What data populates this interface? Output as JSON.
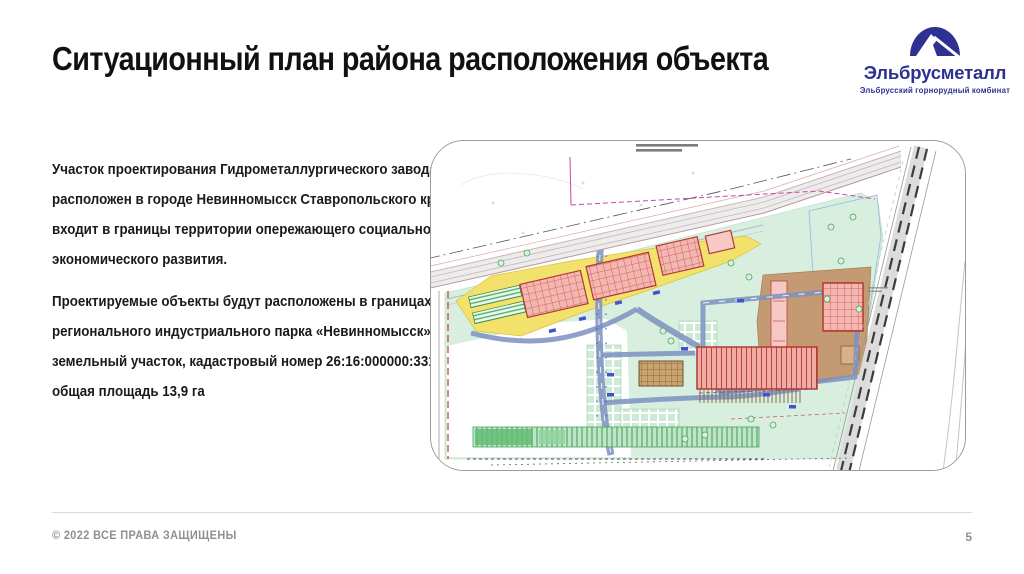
{
  "header": {
    "title": "Ситуационный план района расположения объекта"
  },
  "logo": {
    "name": "Эльбрусметалл",
    "tagline": "Эльбрусский горнорудный комбинат"
  },
  "body": {
    "p1_lines": [
      "Участок проектирования Гидрометаллургического завода",
      "расположен в городе Невинномысск Ставропольского края и",
      "входит в границы территории опережающего социально-",
      "экономического развития."
    ],
    "p2_lines": [
      "Проектируемые объекты будут расположены в границах",
      "регионального индустриального парка «Невинномысск»,",
      "земельный участок, кадастровый номер 26:16:000000:3315,",
      "общая площадь 13,9 га"
    ]
  },
  "footer": {
    "copyright": "© 2022 ВСЕ ПРАВА ЗАЩИЩЕНЫ",
    "page_number": "5"
  },
  "colors": {
    "brand_navy": "#2e3192",
    "title_black": "#111111",
    "footer_gray": "#8f8f8f",
    "map_border": "#9b9b9b",
    "site_green": "#d8efdf",
    "zone_yellow": "#f2e26b",
    "building_pink": "#f4b6b0",
    "building_red": "#b03a32",
    "plant_brown": "#c49a73",
    "road_blue": "#7d90bf",
    "rail_dark": "#3c3c3c"
  }
}
